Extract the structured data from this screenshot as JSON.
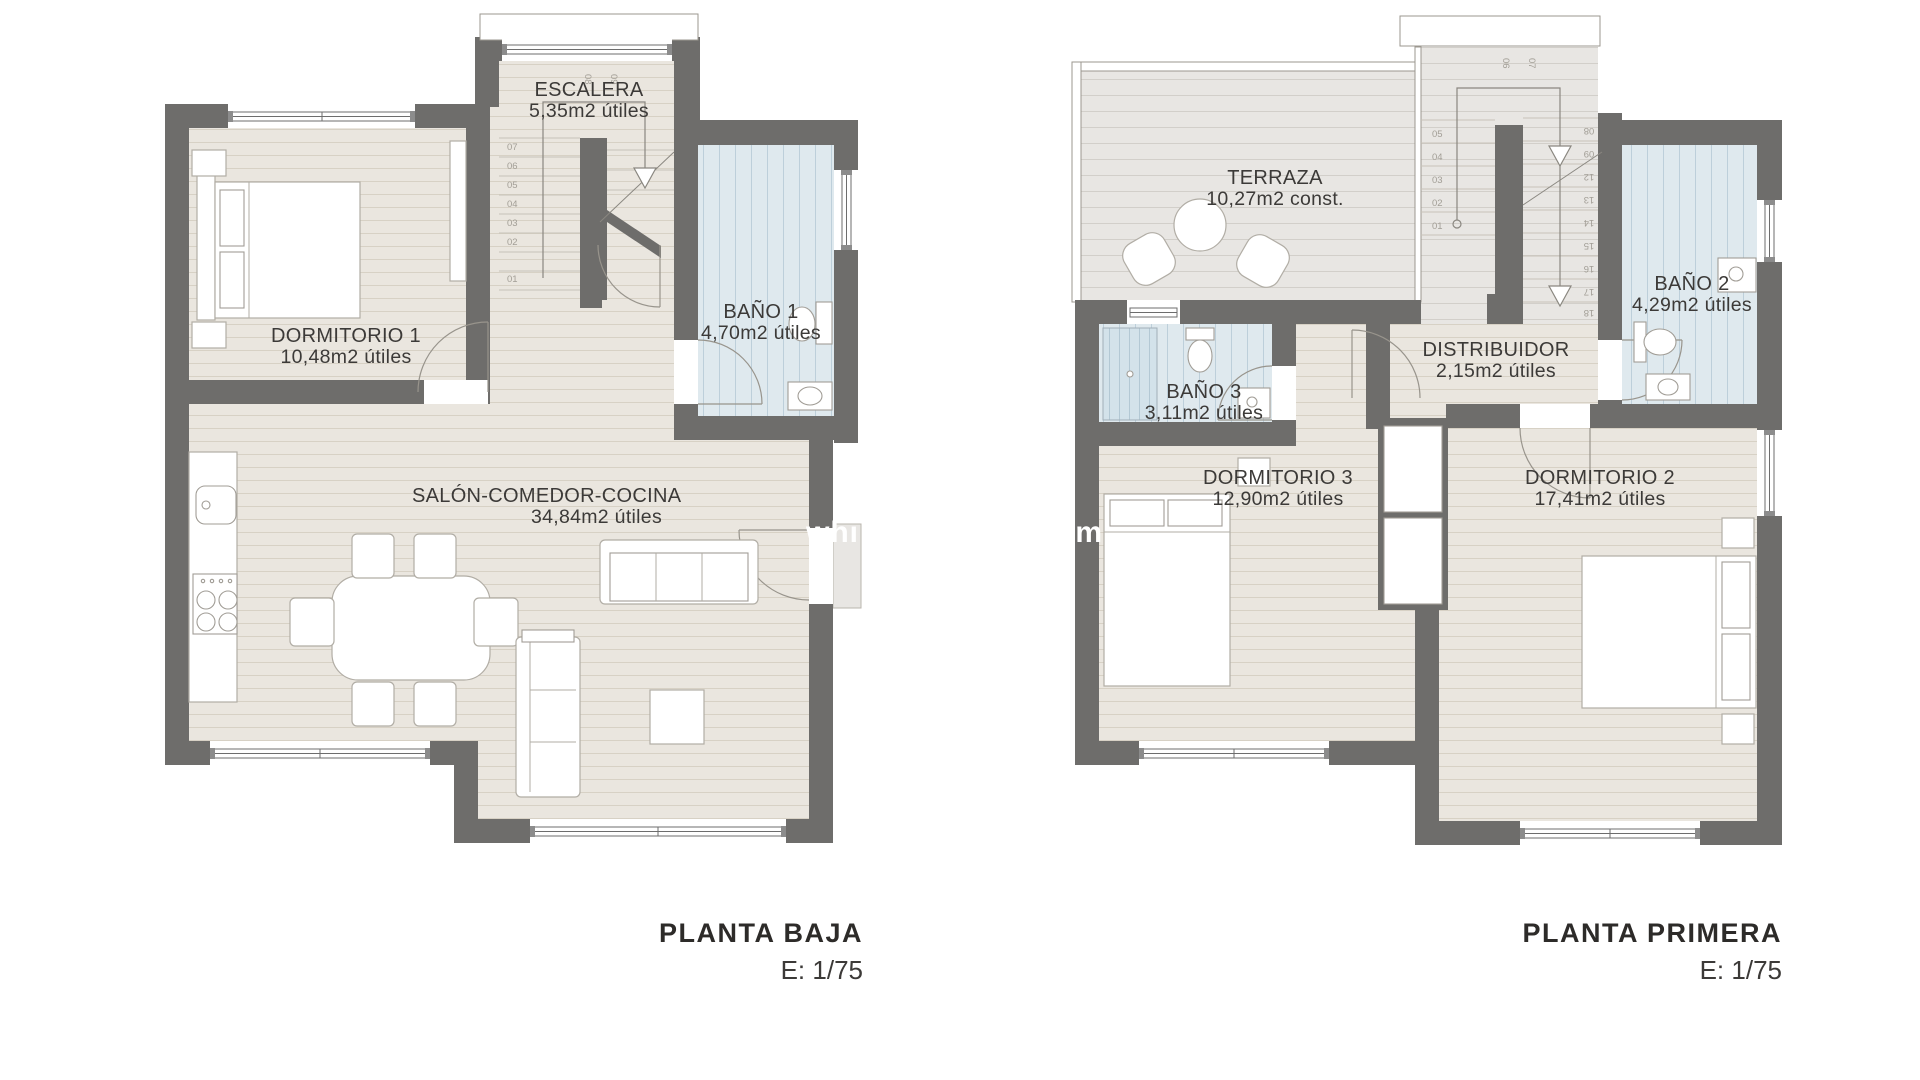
{
  "document": {
    "background": "#ffffff"
  },
  "palette": {
    "wall": "#6e6d6b",
    "floor_plank": "#eae6df",
    "plank_line": "#d7d1c5",
    "terrace_floor": "#e8e6e3",
    "terrace_line": "#d2cfca",
    "bath_floor": "#dfe9ee",
    "bath_stripe": "#bdcfda",
    "shower_stripe": "#b3c8d4",
    "label_text": "#3c3a38",
    "step_number": "#a29e96",
    "watermark": "#ffffff"
  },
  "watermark": {
    "fragments": [
      {
        "text": "whi"
      },
      {
        "text": "om"
      }
    ]
  },
  "plans": [
    {
      "title": "PLANTA BAJA",
      "scale_label": "E: 1/75",
      "rooms": [
        {
          "name": "ESCALERA",
          "area": "5,35m2 útiles"
        },
        {
          "name": "DORMITORIO 1",
          "area": "10,48m2 útiles"
        },
        {
          "name": "BAÑO 1",
          "area": "4,70m2 útiles"
        },
        {
          "name": "SALÓN-COMEDOR-COCINA",
          "area": "34,84m2 útiles"
        }
      ],
      "stair": {
        "left_flight": [
          "07",
          "06",
          "05",
          "04",
          "03",
          "02",
          "01"
        ],
        "turn": [
          "08",
          "09"
        ]
      }
    },
    {
      "title": "PLANTA PRIMERA",
      "scale_label": "E: 1/75",
      "rooms": [
        {
          "name": "TERRAZA",
          "area": "10,27m2 const."
        },
        {
          "name": "BAÑO 2",
          "area": "4,29m2 útiles"
        },
        {
          "name": "BAÑO 3",
          "area": "3,11m2 útiles"
        },
        {
          "name": "DISTRIBUIDOR",
          "area": "2,15m2 útiles"
        },
        {
          "name": "DORMITORIO 3",
          "area": "12,90m2 útiles"
        },
        {
          "name": "DORMITORIO 2",
          "area": "17,41m2 útiles"
        }
      ],
      "stair": {
        "left_flight": [
          "05",
          "04",
          "03",
          "02",
          "01"
        ],
        "turn": [
          "06",
          "07"
        ],
        "right_flight": [
          "08",
          "09",
          "12",
          "13",
          "14",
          "15",
          "16",
          "17",
          "18"
        ]
      }
    }
  ]
}
